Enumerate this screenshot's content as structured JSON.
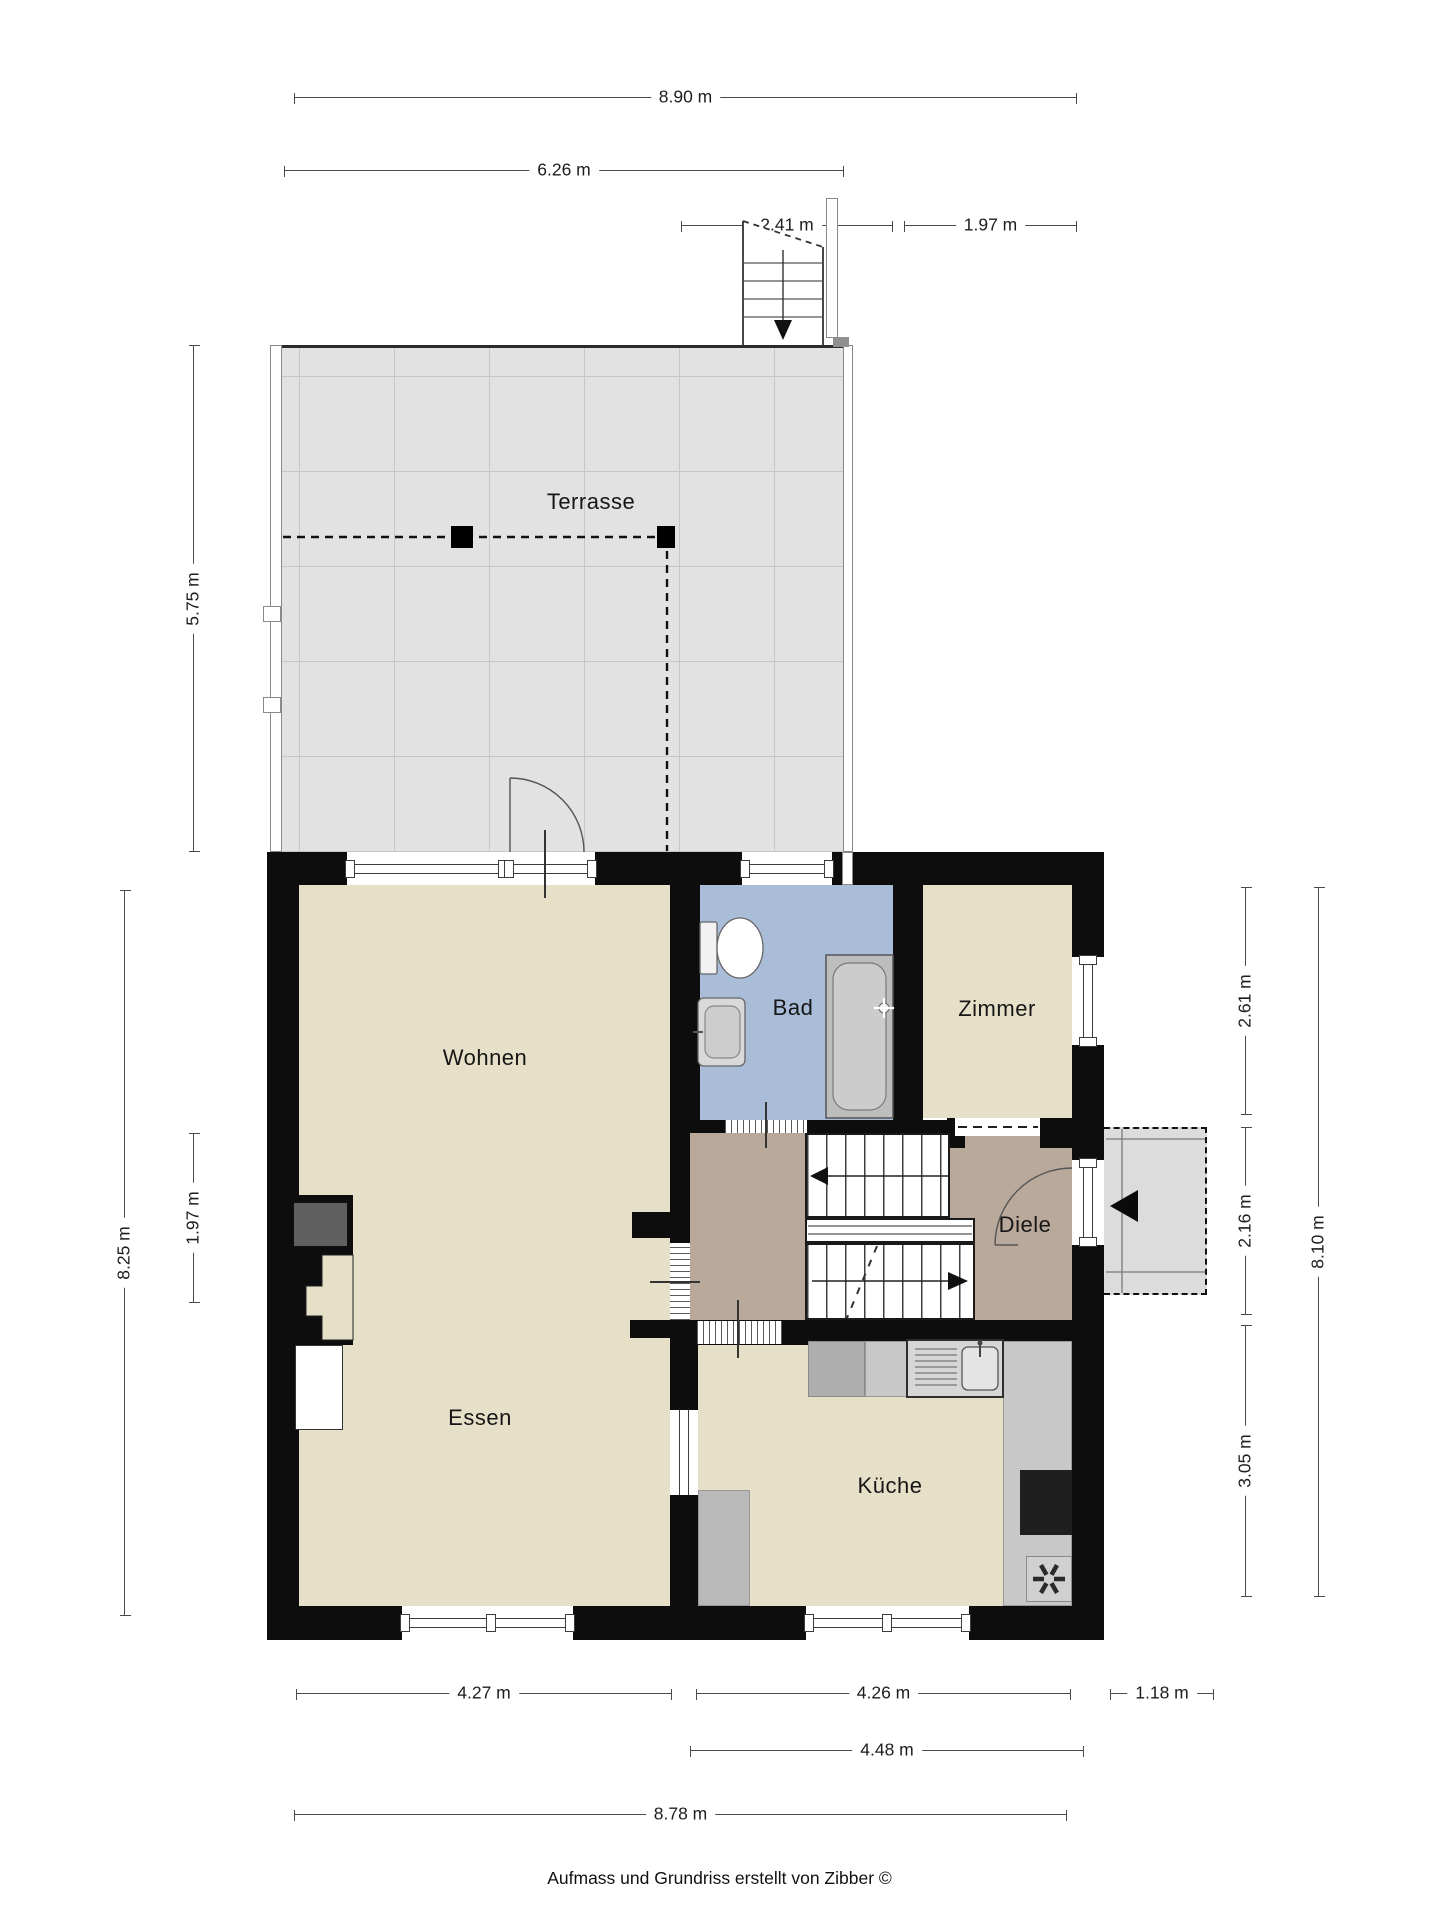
{
  "rooms": {
    "terrasse": "Terrasse",
    "wohnen": "Wohnen",
    "bad": "Bad",
    "zimmer": "Zimmer",
    "diele": "Diele",
    "essen": "Essen",
    "kueche": "Küche"
  },
  "dimensions": {
    "top_overall": "8.90 m",
    "top_terrace": "6.26 m",
    "top_stairs": "2.41 m",
    "top_stairs_side": "1.97 m",
    "left_terrace": "5.75 m",
    "left_house": "8.25 m",
    "left_chimney": "1.97 m",
    "right_zimmer": "2.61 m",
    "right_entrance": "2.16 m",
    "right_kitchen": "3.05 m",
    "right_house": "8.10 m",
    "bottom_living": "4.27 m",
    "bottom_kitchen": "4.26 m",
    "bottom_porch": "1.18 m",
    "bottom_kitchen_total": "4.48 m",
    "bottom_house": "8.78 m"
  },
  "footer": {
    "credit": "Aufmass und Grundriss erstellt von Zibber ©"
  },
  "colors": {
    "wall": "#0d0d0d",
    "room_beige": "#e7e0c9",
    "bathroom_blue": "#a9bdd8",
    "hall_brown": "#b9a99a",
    "terrace_gray": "#e2e2e2",
    "porch_gray": "#dcdcdc",
    "counter_gray": "#c6c6c6",
    "cooktop_black": "#1f1f1f",
    "chimney_gray": "#5f5f5f",
    "dimension_line": "#4a4a4a"
  }
}
